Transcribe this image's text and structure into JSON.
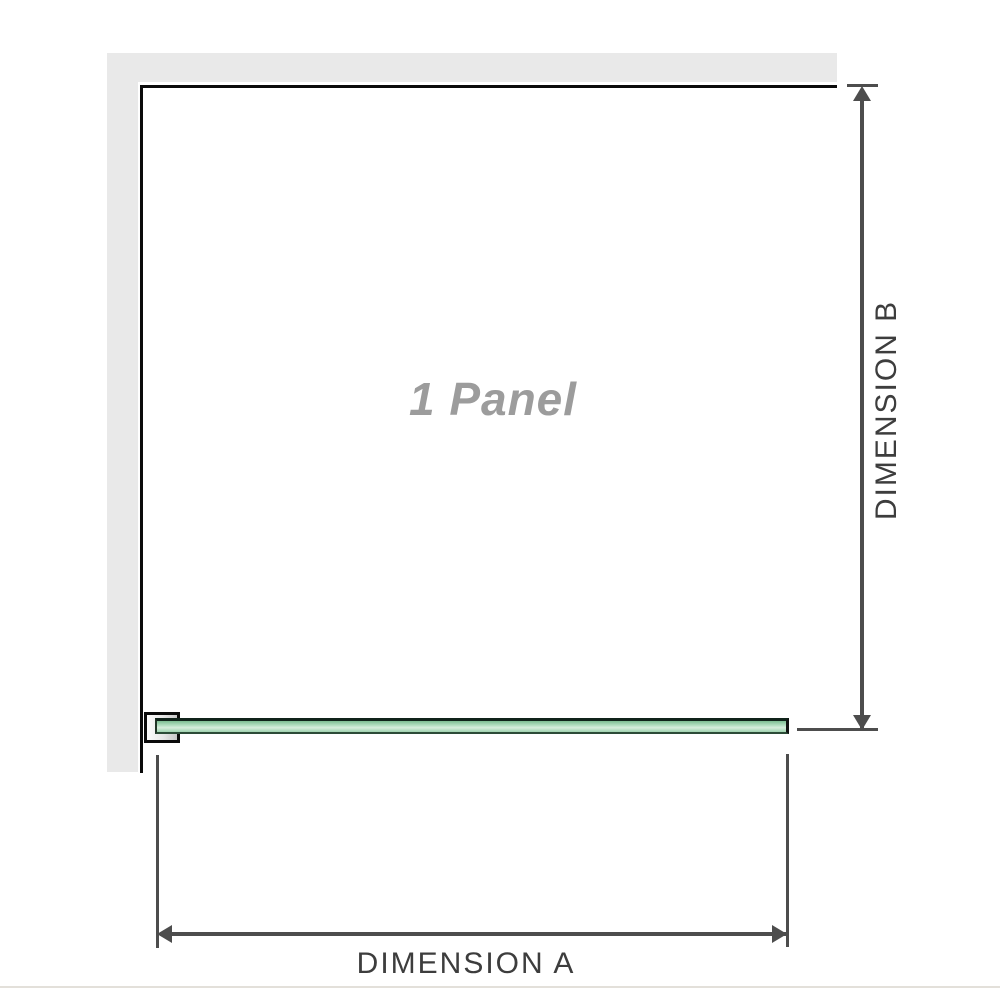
{
  "diagram": {
    "panel_label": "1 Panel",
    "dimension_a": {
      "label": "DIMENSION A"
    },
    "dimension_b": {
      "label": "DIMENSION B"
    }
  },
  "colors": {
    "wall_fill": "#e9e9e9",
    "wall_edge": "#0a0a0a",
    "glass_fill": "#7dbd92",
    "glass_fill_light": "#d8eedd",
    "glass_edge": "#10231a",
    "bracket_fill": "#e0e0e0",
    "dimension_line": "#4d4d4d",
    "label_text": "#3d3d3d",
    "panel_label_text": "#9c9c9c",
    "baseline": "#e3e0da",
    "background": "#ffffff"
  }
}
